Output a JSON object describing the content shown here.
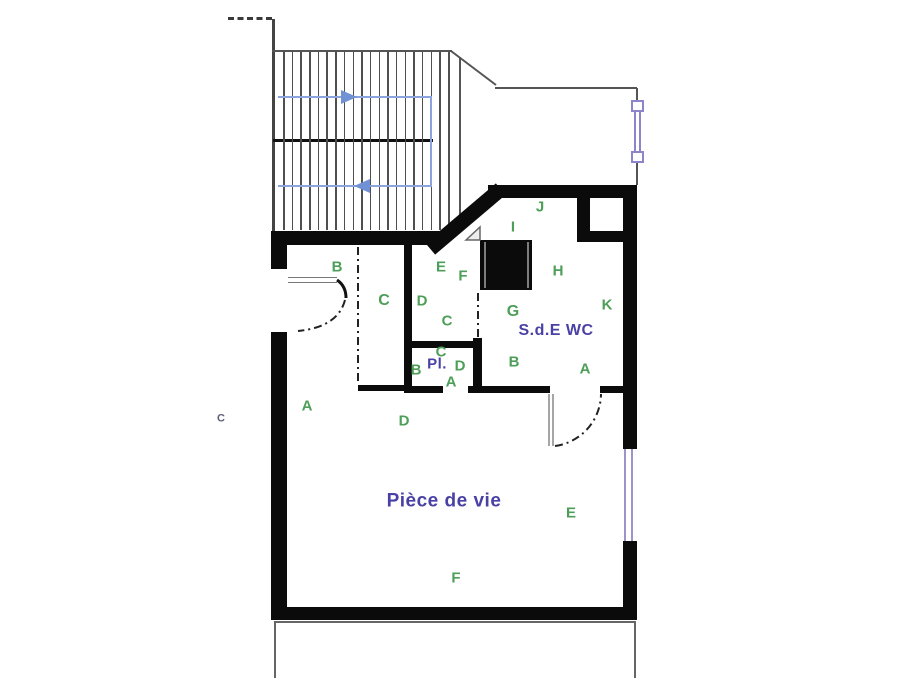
{
  "plan": {
    "title": "apartment-floor-plan",
    "colors": {
      "wall": "#0b0b0b",
      "thin_line": "#555555",
      "stair_path_blue": "#8ba4dd",
      "arrow_blue": "#7191d5",
      "window_purple": "#9a92cf",
      "zone_label_green": "#4d9e58",
      "room_name_blue": "#4a41a5"
    },
    "room_names": {
      "living_room": "Pièce de vie",
      "bathroom": "S.d.E WC",
      "closet": "Pl."
    },
    "labels": [
      {
        "text": "B",
        "x": 337,
        "y": 267,
        "kind": "g",
        "size": 15
      },
      {
        "text": "C",
        "x": 384,
        "y": 301,
        "kind": "g",
        "size": 16
      },
      {
        "text": "E",
        "x": 441,
        "y": 267,
        "kind": "g",
        "size": 15
      },
      {
        "text": "F",
        "x": 463,
        "y": 276,
        "kind": "g",
        "size": 15
      },
      {
        "text": "D",
        "x": 422,
        "y": 301,
        "kind": "g",
        "size": 15
      },
      {
        "text": "C",
        "x": 447,
        "y": 321,
        "kind": "g",
        "size": 15
      },
      {
        "text": "C",
        "x": 441,
        "y": 352,
        "kind": "g",
        "size": 15
      },
      {
        "text": "B",
        "x": 416,
        "y": 370,
        "kind": "g",
        "size": 15
      },
      {
        "text": "D",
        "x": 460,
        "y": 366,
        "kind": "g",
        "size": 15
      },
      {
        "text": "A",
        "x": 451,
        "y": 382,
        "kind": "g",
        "size": 15
      },
      {
        "text": "A",
        "x": 307,
        "y": 406,
        "kind": "g",
        "size": 15
      },
      {
        "text": "D",
        "x": 404,
        "y": 421,
        "kind": "g",
        "size": 15
      },
      {
        "text": "J",
        "x": 540,
        "y": 207,
        "kind": "g",
        "size": 15
      },
      {
        "text": "I",
        "x": 513,
        "y": 227,
        "kind": "g",
        "size": 15
      },
      {
        "text": "H",
        "x": 558,
        "y": 271,
        "kind": "g",
        "size": 15
      },
      {
        "text": "G",
        "x": 513,
        "y": 312,
        "kind": "g",
        "size": 16
      },
      {
        "text": "K",
        "x": 607,
        "y": 305,
        "kind": "g",
        "size": 15
      },
      {
        "text": "B",
        "x": 514,
        "y": 362,
        "kind": "g",
        "size": 15
      },
      {
        "text": "A",
        "x": 585,
        "y": 369,
        "kind": "g",
        "size": 15
      },
      {
        "text": "E",
        "x": 571,
        "y": 513,
        "kind": "g",
        "size": 15
      },
      {
        "text": "F",
        "x": 456,
        "y": 578,
        "kind": "g",
        "size": 15
      },
      {
        "text": "Pl.",
        "x": 437,
        "y": 364,
        "kind": "b",
        "size": 15
      },
      {
        "text": "S.d.E WC",
        "x": 556,
        "y": 331,
        "kind": "b",
        "size": 16
      },
      {
        "text": "Pièce de vie",
        "x": 444,
        "y": 501,
        "kind": "b",
        "size": 19
      },
      {
        "text": "C",
        "x": 221,
        "y": 419,
        "kind": "s",
        "size": 11
      }
    ],
    "stairs": {
      "riser_count": 20,
      "x_start": 283,
      "x_end": 448,
      "y_top": 52,
      "y_bottom": 230
    }
  }
}
